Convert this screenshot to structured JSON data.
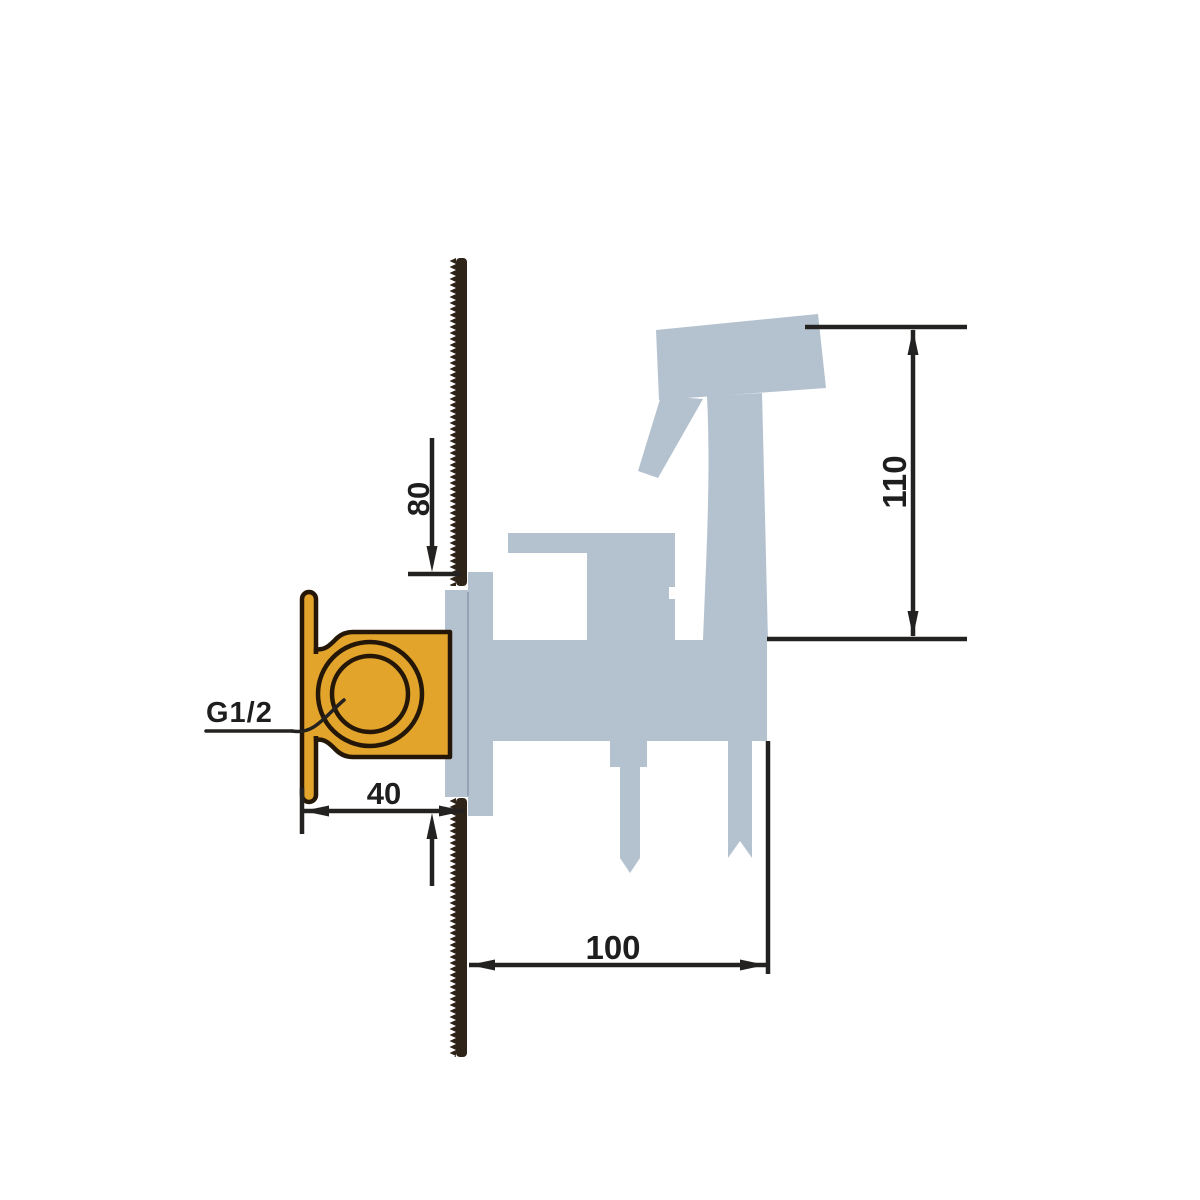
{
  "canvas": {
    "background": "#ffffff"
  },
  "labels": {
    "dim_height_offset": "80",
    "dim_sprayer_height": "110",
    "dim_embed_depth": "40",
    "dim_outlet_distance": "100",
    "thread": "G1/2"
  },
  "colors": {
    "fixture_silhouette": "#b4c2d0",
    "valve_body": "#e2a42a",
    "valve_outline": "#241708",
    "wall_section": "#2e2418",
    "dimension_line": "#242220",
    "label_text": "#1e1e1e",
    "plate_edge": "#94a4b4",
    "background": "#ffffff"
  }
}
